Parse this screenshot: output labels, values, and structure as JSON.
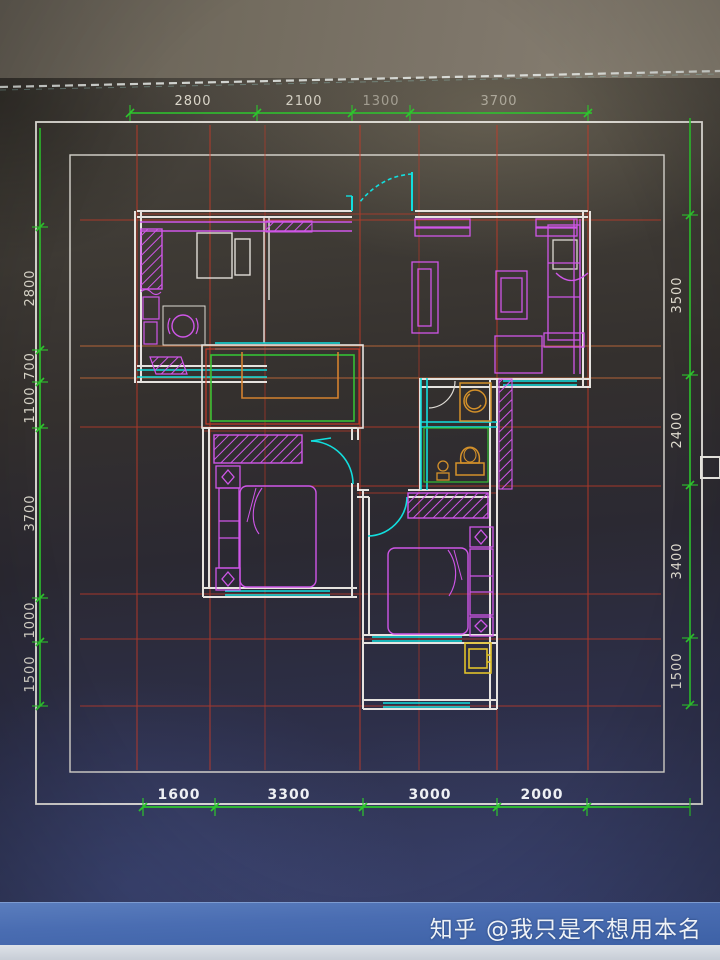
{
  "watermark": {
    "brand": "知乎",
    "author": "@我只是不想用本名"
  },
  "dimensions": {
    "top": [
      "2800",
      "2100",
      "1300",
      "3700"
    ],
    "bottom": [
      "1600",
      "3300",
      "3000",
      "2000"
    ],
    "left": [
      "2800",
      "700",
      "1100",
      "3700",
      "1000",
      "1500"
    ],
    "right": [
      "3500",
      "2400",
      "3400",
      "1500"
    ]
  },
  "colors": {
    "dimension_line": "#2dc72d",
    "axis_grid_red": "#c43b28",
    "wall_white": "#e6e3df",
    "window_cyan": "#12dede",
    "furniture_magenta": "#cf56e8",
    "fixture_orange": "#d4912a",
    "balcony_fixture_yellow": "#e0c22a",
    "bay_window_green": "#35c035",
    "watermark_bar_blue": "#4a6db2"
  }
}
